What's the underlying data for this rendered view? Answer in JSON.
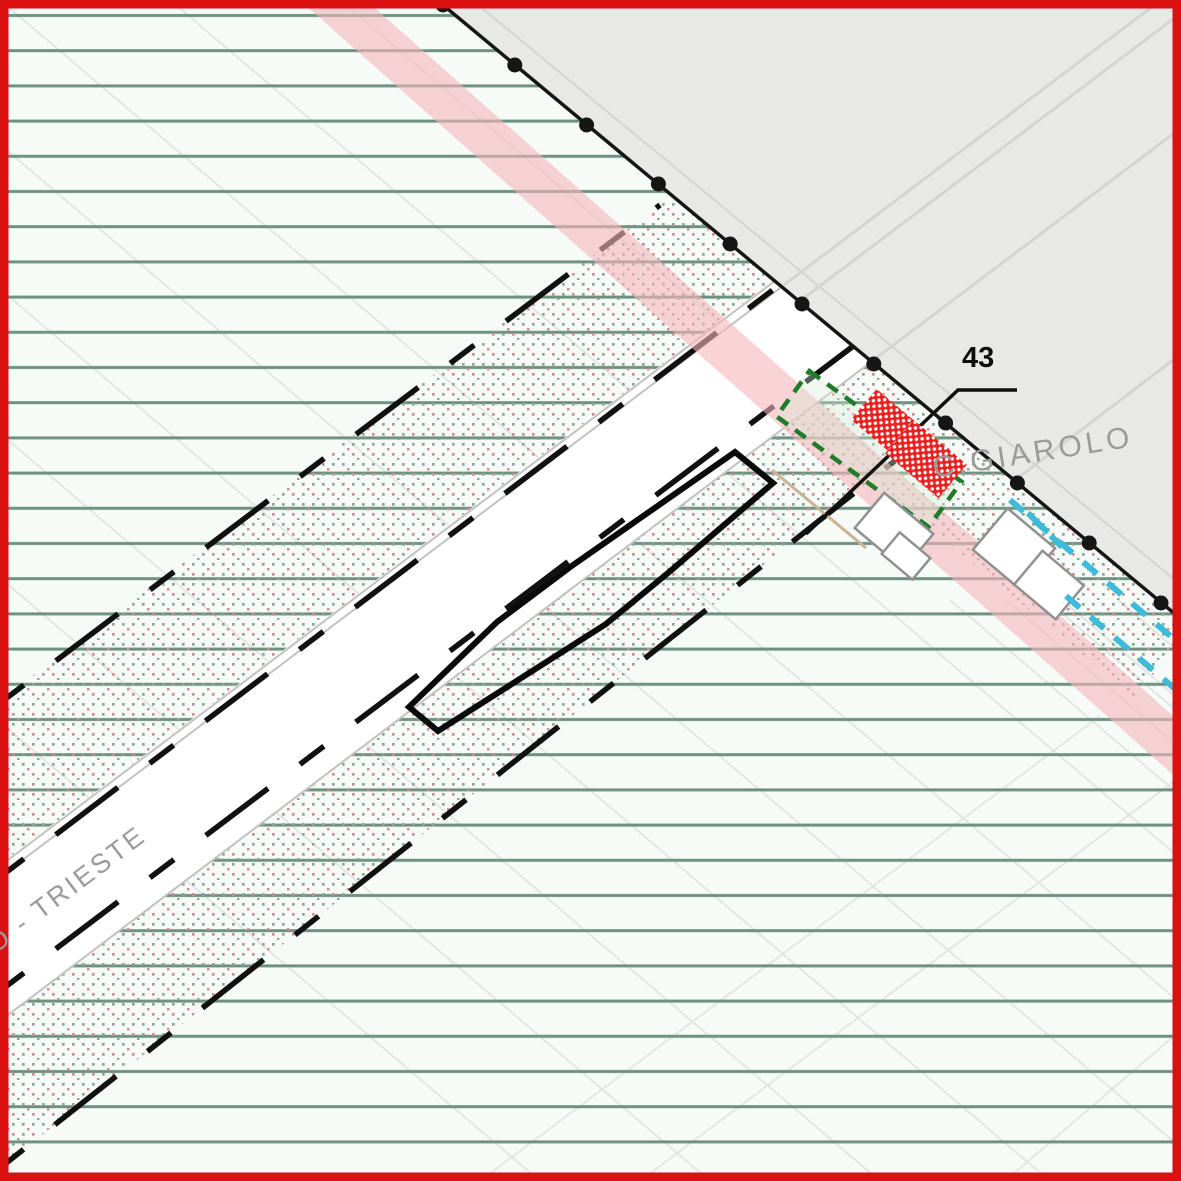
{
  "map": {
    "type": "zoning-plan",
    "labels": {
      "parcel_number": "43",
      "locality_name": "C.GIAROLO",
      "road_name": "O - TRIESTE"
    },
    "colors": {
      "frame": "#db1010",
      "map_background": "#f6fbf8",
      "hatch_line": "#6f9180",
      "parcel_line": "#e3e6e4",
      "urban_area": "#e8e8e7",
      "urban_road_line": "#d4d4d4",
      "boundary": "#161616",
      "dot_green": "#93a496",
      "dot_red": "#d09090",
      "road_edge": "#c2c2c2",
      "dashed_line": "#111111",
      "pink_band": "#f5b6ba",
      "plan_outline": "#0a0a0a",
      "green_dashed_zone": "#1e7c2a",
      "green_zone_fill": "#d7ecd7",
      "building_red": "#ec1f1f",
      "building_outline_gray": "#909090",
      "cyan_dashed": "#3dbbd8",
      "label_gray": "#9b9b9b",
      "tan_line": "#c9b493"
    }
  }
}
